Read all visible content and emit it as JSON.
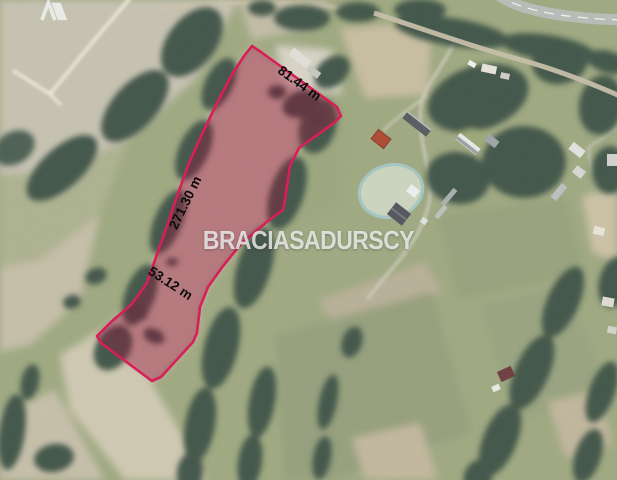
{
  "image_type": "satellite-aerial-photo-of-land-plot-listing",
  "watermark": {
    "brand_first": "BRACIA",
    "brand_second": "SADURSCY",
    "logo": "caret-and-slanted-square-mark",
    "text_color": "#f0f4f3"
  },
  "plot": {
    "boundary_color": "#d81f58",
    "fill_tint": "rgba(158,14,62,0.36)",
    "label_color": "#0b0b0b",
    "measurements": {
      "north_edge": "81.44 m",
      "west_edge": "271.30 m",
      "south_width": "53.12 m"
    }
  },
  "map_palette": {
    "field_tan": "#c7c3b2",
    "field_green": "#9aa47e",
    "trees": "#435749",
    "paved_road": "#b8bdb8",
    "road_center_line": "#f2f2ee",
    "dirt_road": "#c6bfa9",
    "red_roof_house": "#ad4a33",
    "riding_arena_ring": "#a5c6c2"
  }
}
